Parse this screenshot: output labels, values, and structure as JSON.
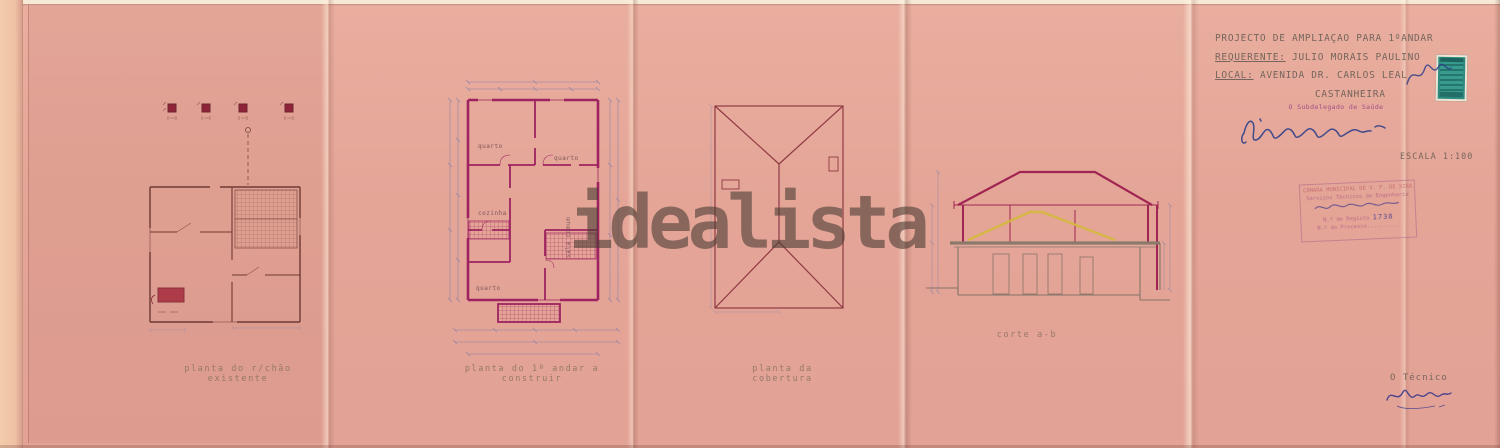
{
  "watermark": "idealista",
  "captions": {
    "plan1": "planta do r/chão existente",
    "plan2": "planta do 1º andar a construir",
    "plan3": "planta da cobertura",
    "section": "corte a-b"
  },
  "title_block": {
    "project": "PROJECTO DE AMPLIAÇÃO PARA 1ºANDAR",
    "requerente_label": "REQUERENTE:",
    "requerente": "JULIO MORAIS PAULINO",
    "local_label": "LOCAL:",
    "local": "AVENIDA  DR. CARLOS LEAL",
    "locality": "CASTANHEIRA",
    "health_officer": "O Subdelegado de Saúde",
    "scale": "ESCALA 1:100",
    "technician_label": "O Técnico"
  },
  "municipal_stamp": {
    "line1": "CÂMARA MUNICIPAL DE V. F. DE XIRA",
    "line2": "Serviços Técnicos de Engenharia",
    "registo_label": "N.º de Registo",
    "registo_number": "1738",
    "processo_label": "N.º do Processo"
  },
  "room_labels": [
    "quarto",
    "quarto",
    "cozinha",
    "quarto",
    "sala comum"
  ],
  "colors": {
    "paper": "#e4a597",
    "wall_magenta": "#9e2360",
    "line_dark_red": "#6e3a34",
    "old_roof_yellow": "#d4b83c",
    "fiscal_stamp_teal": "#2f8a80",
    "ink_blue": "#2f3f8a"
  }
}
